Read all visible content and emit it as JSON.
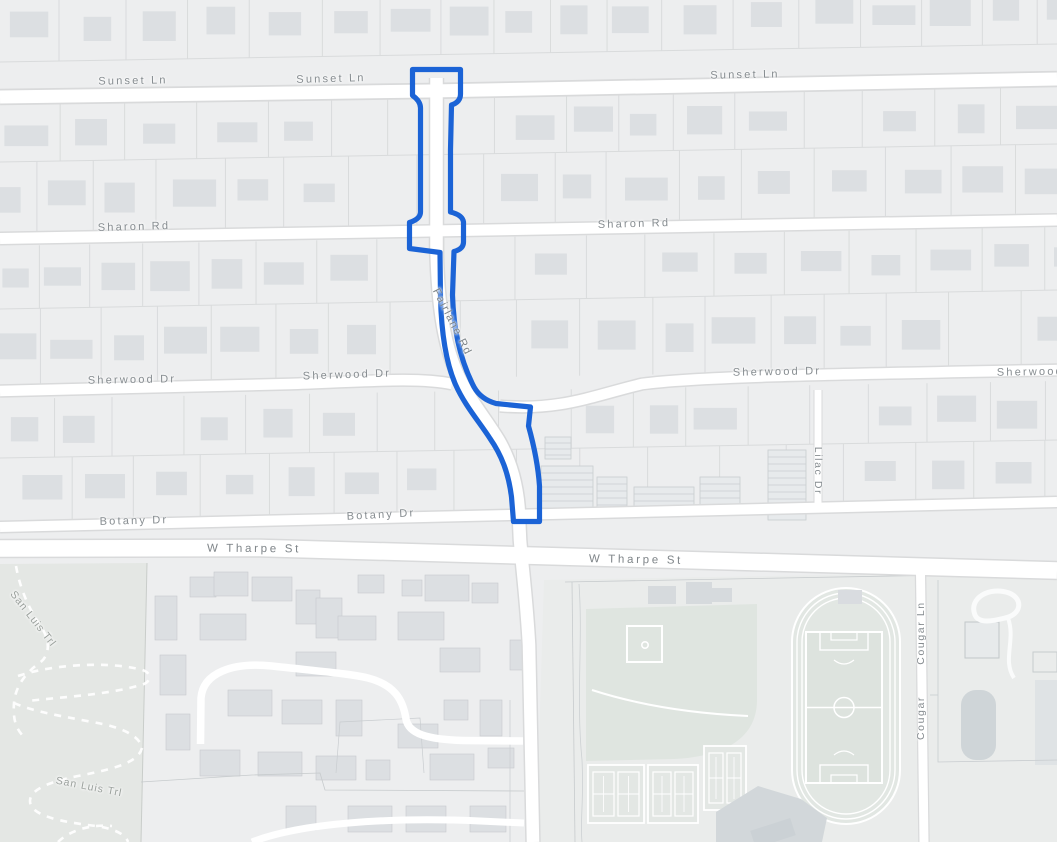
{
  "map": {
    "title": "Neighborhood street map with highlighted road",
    "highlighted_street": "Fairlane Rd",
    "route": {
      "street": "Fairlane Rd",
      "from": "Sunset Ln",
      "to": "Botany Dr"
    }
  },
  "colors": {
    "bg": "#edeeef",
    "road": "#ffffff",
    "casing": "#d9dadb",
    "parcel": "#d9dbdc",
    "building": "#dcdfe2",
    "buildingDark": "#d2d7da",
    "park": "#e4e7e4",
    "field": "#dfe5e0",
    "pitch": "#dde3de",
    "school": "#eaeceb",
    "route": "#1b63d6",
    "label": "#868c90"
  },
  "labels": [
    {
      "id": "sunset-ln-1",
      "text": "Sunset Ln"
    },
    {
      "id": "sunset-ln-2",
      "text": "Sunset Ln"
    },
    {
      "id": "sunset-ln-3",
      "text": "Sunset Ln"
    },
    {
      "id": "sharon-rd-1",
      "text": "Sharon Rd"
    },
    {
      "id": "sharon-rd-2",
      "text": "Sharon Rd"
    },
    {
      "id": "sherwood-dr-1",
      "text": "Sherwood Dr"
    },
    {
      "id": "sherwood-dr-2",
      "text": "Sherwood Dr"
    },
    {
      "id": "sherwood-dr-3",
      "text": "Sherwood Dr"
    },
    {
      "id": "sherwood-dr-4",
      "text": "Sherwood Dr"
    },
    {
      "id": "fairlane-rd",
      "text": "Fairlane Rd"
    },
    {
      "id": "botany-dr-1",
      "text": "Botany Dr"
    },
    {
      "id": "botany-dr-2",
      "text": "Botany Dr"
    },
    {
      "id": "w-tharpe-st-1",
      "text": "W Tharpe St"
    },
    {
      "id": "w-tharpe-st-2",
      "text": "W Tharpe St"
    },
    {
      "id": "lilac-dr",
      "text": "Lilac Dr"
    },
    {
      "id": "cougar-ln-1",
      "text": "Cougar Ln"
    },
    {
      "id": "cougar-ln-2",
      "text": "Cougar"
    },
    {
      "id": "san-luis-trl-1",
      "text": "San Luis Trl"
    },
    {
      "id": "san-luis-trl-2",
      "text": "San Luis Trl"
    }
  ]
}
